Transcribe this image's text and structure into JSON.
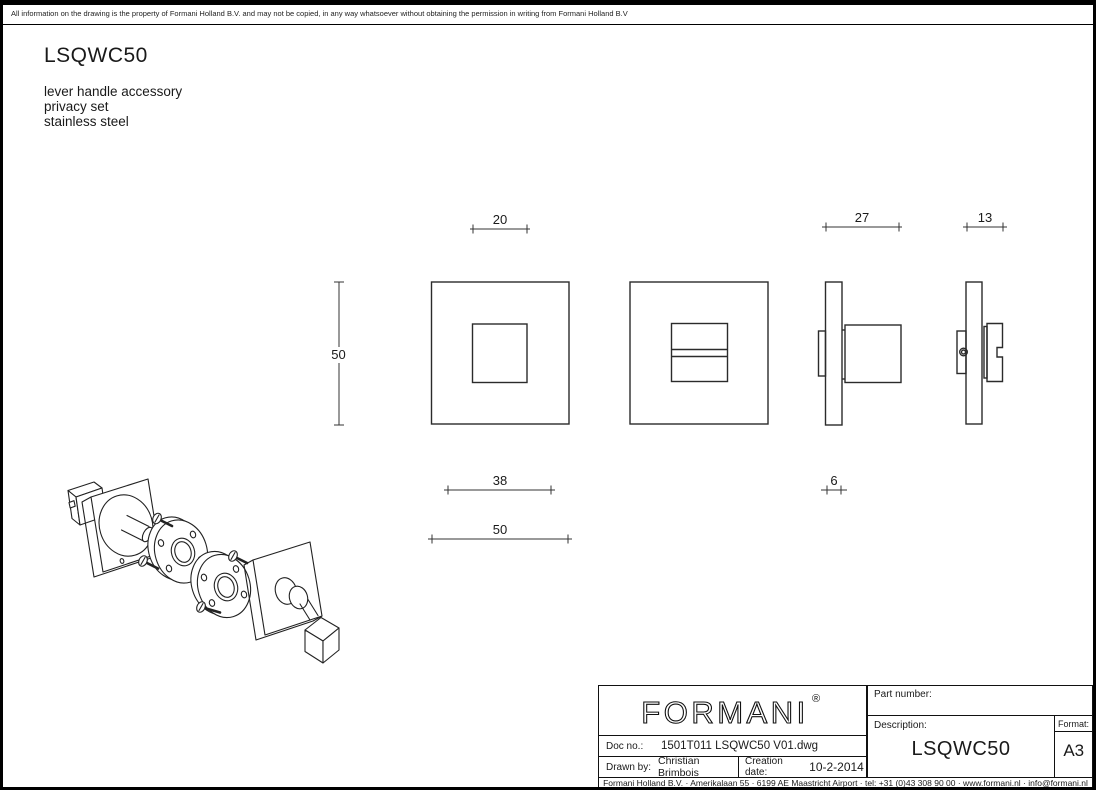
{
  "page": {
    "disclaimer": "All information on the drawing is the property of Formani Holland B.V. and may not be copied, in any way whatsoever without obtaining the permission in writing from Formani Holland B.V",
    "product_code": "LSQWC50",
    "subtitle_lines": [
      "lever handle accessory",
      "privacy set",
      "stainless steel"
    ]
  },
  "dims": {
    "inner_square": "20",
    "privacy_side_depth": "27",
    "release_side_depth": "13",
    "rosette_height": "50",
    "recess_width": "38",
    "rosette_width": "50",
    "plate_thickness": "6"
  },
  "title_block": {
    "logo_text": "FORMANI",
    "logo_reg": "®",
    "part_number_label": "Part number:",
    "description_label": "Description:",
    "description_value": "LSQWC50",
    "format_label": "Format:",
    "format_value": "A3",
    "doc_no_label": "Doc no.:",
    "doc_no_value": "1501T011 LSQWC50 V01.dwg",
    "drawn_by_label": "Drawn by:",
    "drawn_by_value": "Christian Brimbois",
    "creation_date_label": "Creation date:",
    "creation_date_value": "10-2-2014",
    "company_footer": "Formani Holland B.V. · Amerikalaan 55 · 6199 AE Maastricht Airport · tel: +31 (0)43 308 90 00 · www.formani.nl · info@formani.nl"
  },
  "colors": {
    "line": "#1a1a1a",
    "background": "#ffffff"
  }
}
